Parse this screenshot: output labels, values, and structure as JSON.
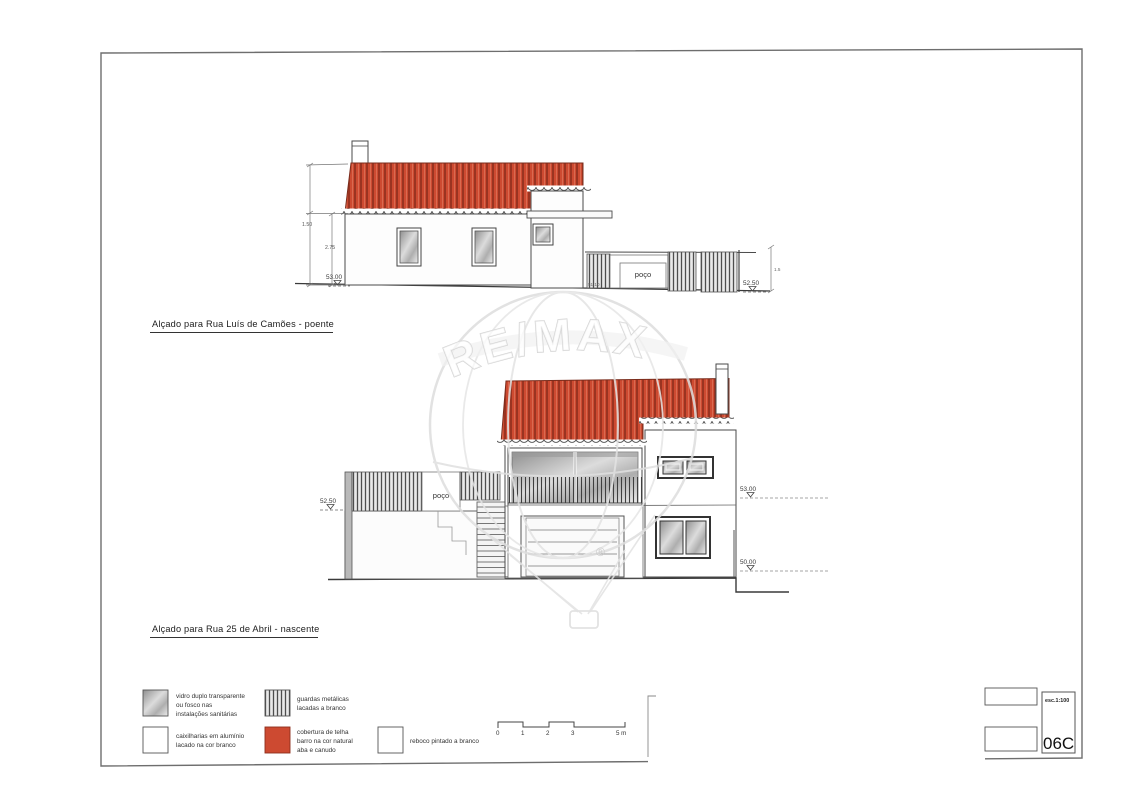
{
  "page": {
    "elevations": {
      "poente": {
        "title": "Alçado para Rua Luís de Camões - poente",
        "level_ground_left": "53.00",
        "level_ground_right": "52.50",
        "dim_total": "1.50",
        "dim_wall": "2.75",
        "dim_fence_height": "1.5",
        "gate_level": "51.10",
        "well_label": "poço"
      },
      "nascente": {
        "title": "Alçado para Rua 25 de Abril - nascente",
        "level_street_left": "52.50",
        "level_first_floor": "53.00",
        "level_ground_floor": "50.00",
        "well_label": "poço"
      }
    },
    "legend": {
      "items": [
        {
          "swatch": "glass-gradient",
          "label_lines": [
            "vidro duplo transparente",
            "ou fosco nas",
            "instalações sanitárias"
          ]
        },
        {
          "swatch": "white",
          "label_lines": [
            "caixilharias em alumínio",
            "lacado na cor branco"
          ]
        },
        {
          "swatch": "metal-stripes",
          "label_lines": [
            "guardas metálicas",
            "lacadas a branco"
          ]
        },
        {
          "swatch": "roof-red",
          "label_lines": [
            "cobertura de telha",
            "barro na cor natural",
            "aba e canudo"
          ]
        },
        {
          "swatch": "white",
          "label_lines": [
            "reboco pintado a branco"
          ]
        }
      ]
    },
    "scalebar": {
      "labels": [
        "0",
        "1",
        "2",
        "3",
        "5 m"
      ]
    },
    "titleblock": {
      "scale_label": "esc.1:100",
      "drawing_number": "06C"
    },
    "watermark": {
      "brand": "RE/MAX",
      "registered": "®"
    },
    "colors": {
      "roof_red": "#cd4a31",
      "roof_stripe": "#8e2f1d",
      "ink": "#3a3a3a",
      "watermark_gray": "#d9d9d9"
    }
  }
}
